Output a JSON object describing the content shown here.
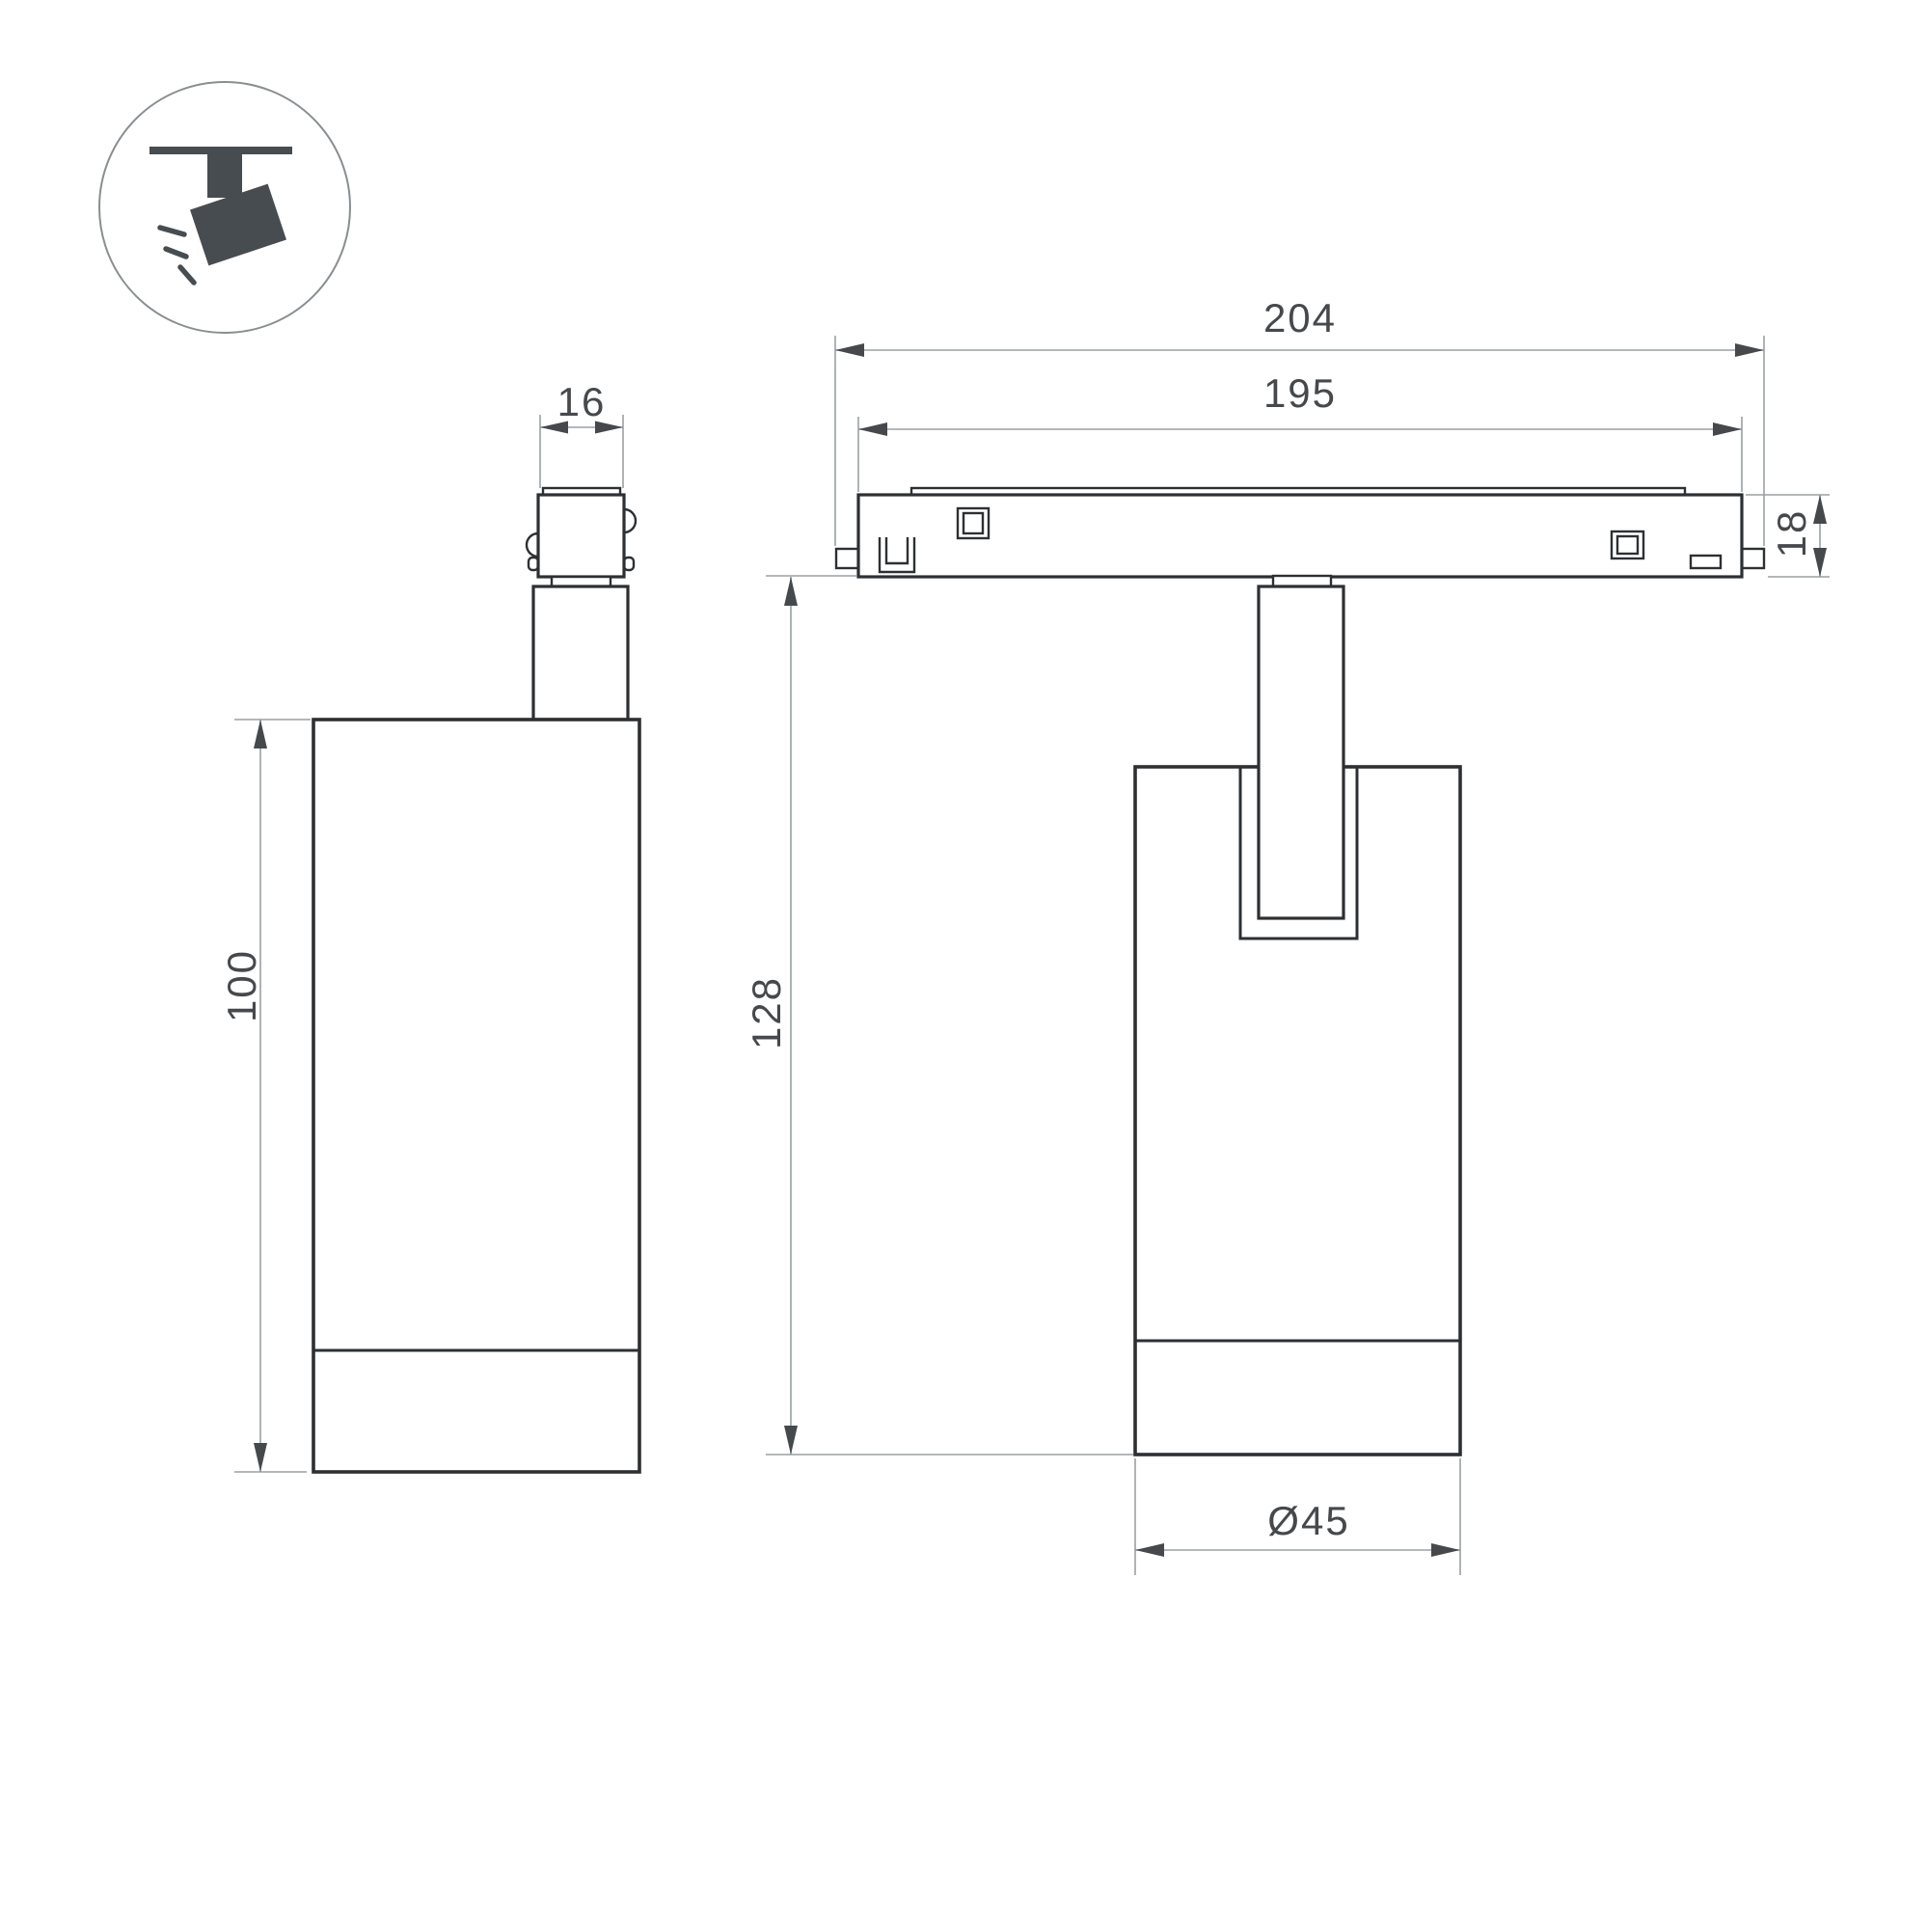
{
  "theme": {
    "outline_color": "#2d3033",
    "dim_line_color": "#9aa0a3",
    "dim_text_color": "#46494c",
    "icon_color": "#474c51",
    "icon_ring_color": "#898e91",
    "background": "#ffffff"
  },
  "icon": {
    "name": "ceiling-track-spotlight"
  },
  "dimensions": {
    "adapter_width": "16",
    "track_overall_length": "204",
    "track_inner_length": "195",
    "track_height": "18",
    "body_height": "100",
    "total_height": "128",
    "body_diameter": "Ø45"
  }
}
